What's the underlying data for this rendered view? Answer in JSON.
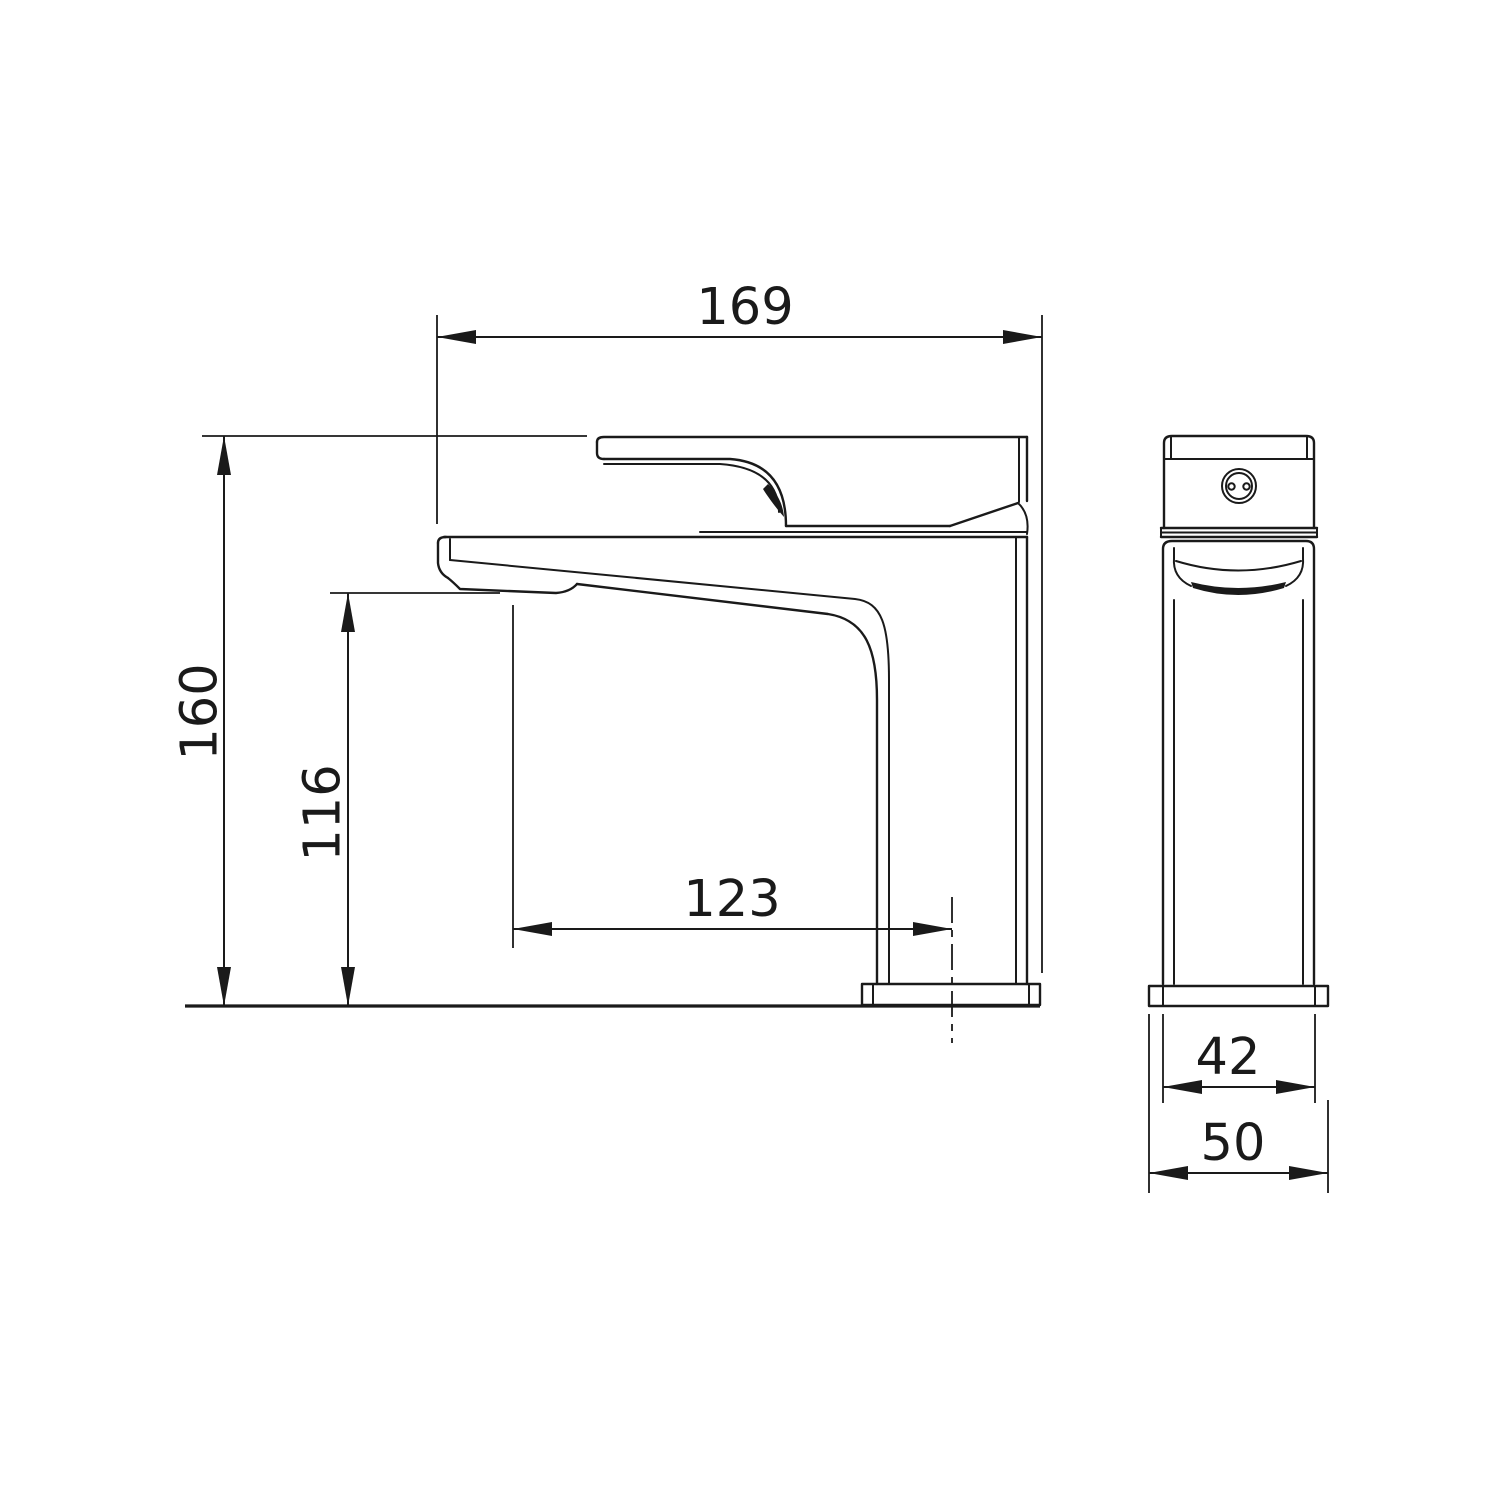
{
  "drawing": {
    "title": "single-lever basin mixer tap technical drawing",
    "views": {
      "side_view": "faucet side elevation",
      "front_view": "faucet front elevation"
    },
    "dimensions": {
      "overall_length": "169",
      "overall_height": "160",
      "spout_height": "116",
      "spout_reach": "123",
      "body_width": "42",
      "base_width": "50"
    }
  },
  "colors": {
    "line": "#1a1a1a",
    "background": "#ffffff"
  }
}
